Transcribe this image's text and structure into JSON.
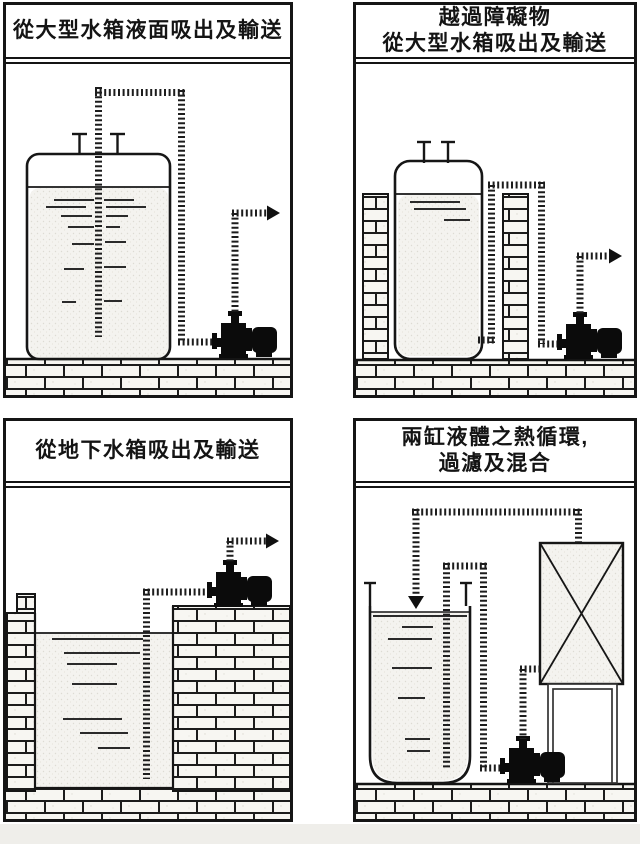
{
  "document": {
    "language": "zh-Hant",
    "kind": "pump application diagrams sheet",
    "background": "#ffffff",
    "scan_edge_color": "#efeeea"
  },
  "colors": {
    "ink": "#151515",
    "panel_border": "#151515",
    "brick_fill": "#f7f6f2",
    "liquid_fill": "#f4f3ef",
    "pump_silhouette": "#0b0b0b"
  },
  "icons": {
    "pump": "pump-silhouette-icon",
    "flow_arrow_right": "solid-right-triangle",
    "flow_arrow_down": "solid-down-triangle",
    "pipe_style": "dashed-ladder-pipe"
  },
  "panels": [
    {
      "id": "top-left",
      "title": "從大型水箱液面吸出及輸送"
    },
    {
      "id": "top-right",
      "title": "越過障礙物\n從大型水箱吸出及輸送"
    },
    {
      "id": "bottom-left",
      "title": "從地下水箱吸出及輸送"
    },
    {
      "id": "bottom-right",
      "title": "兩缸液體之熱循環,\n過濾及混合"
    }
  ]
}
